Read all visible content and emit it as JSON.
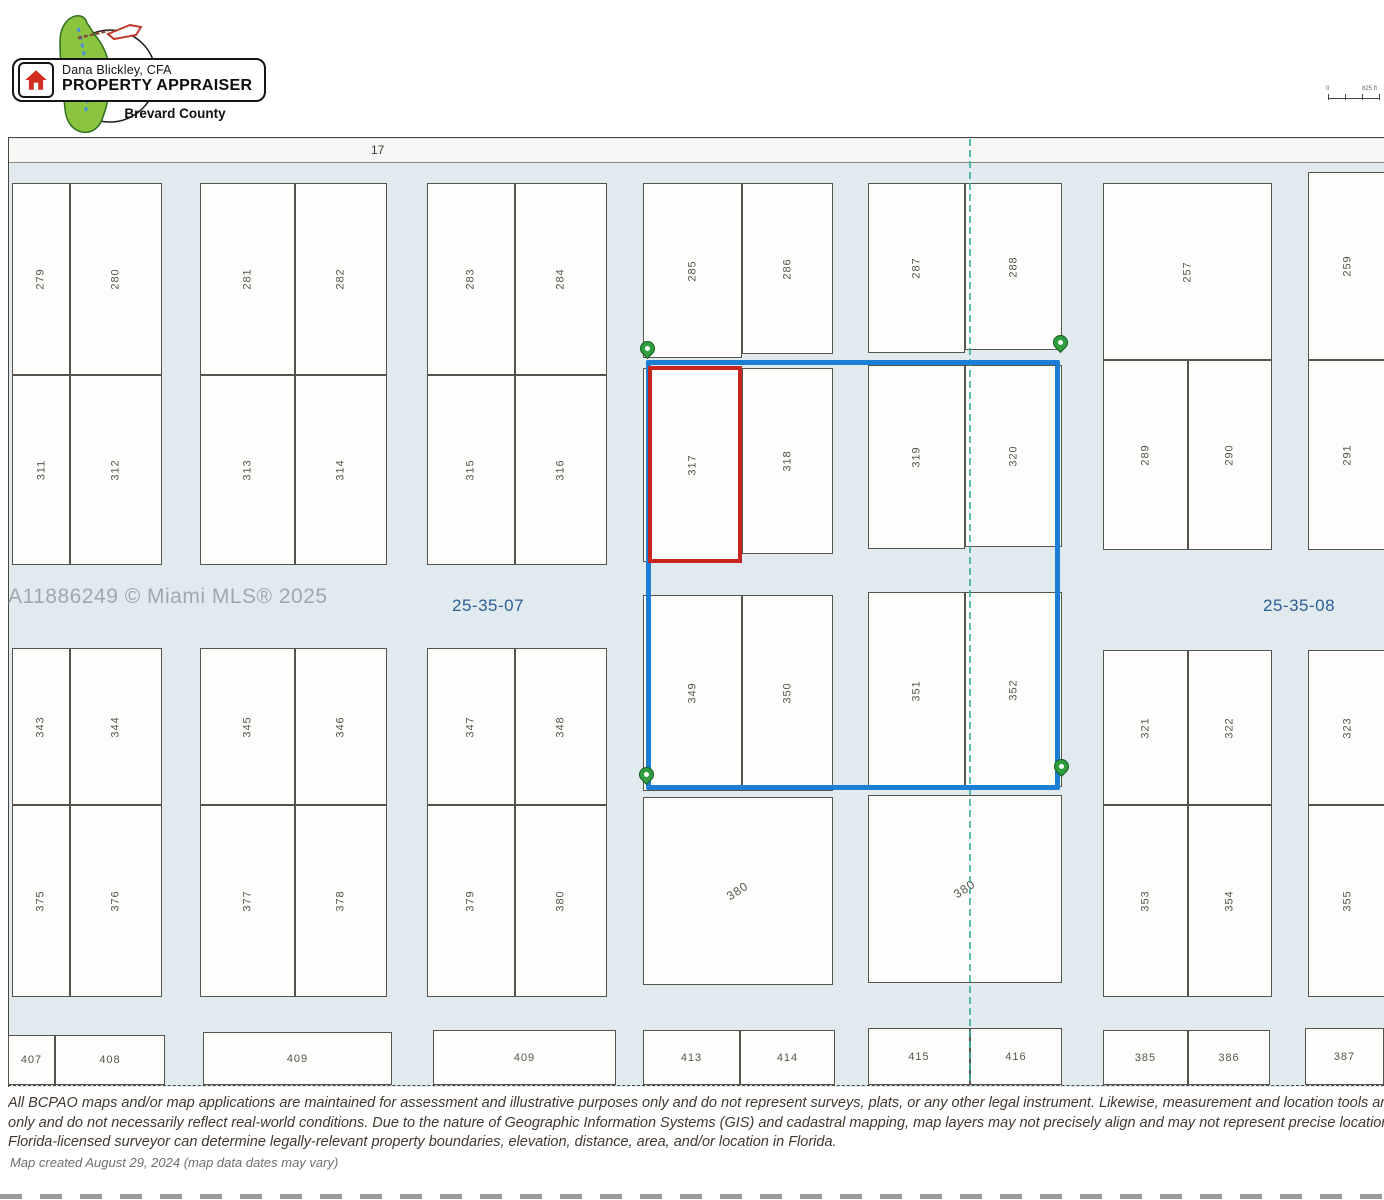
{
  "header": {
    "logo": {
      "line1": "Dana Blickley, CFA",
      "line2": "PROPERTY APPRAISER",
      "line3": "Brevard County"
    },
    "scale_bar": {
      "start": "0",
      "end": "825 ft"
    }
  },
  "map": {
    "road_label": "17",
    "watermark": "A11886249 © Miami MLS® 2025",
    "section_labels": [
      {
        "text": "25-35-07"
      },
      {
        "text": "25-35-08"
      }
    ],
    "section_line_x": 969,
    "selection_box": {
      "x": 646,
      "y": 360,
      "w": 414,
      "h": 430
    },
    "highlight_box": {
      "x": 648,
      "y": 366,
      "w": 94,
      "h": 197
    },
    "pins": [
      {
        "x": 647,
        "y": 353
      },
      {
        "x": 1060,
        "y": 347
      },
      {
        "x": 646,
        "y": 779
      },
      {
        "x": 1061,
        "y": 771
      }
    ],
    "colors": {
      "street": "#e1eaef",
      "parcel": "#fdfdfb",
      "parcelBorder": "#55534a",
      "road": "#f7f8f5",
      "blue": "#1a7fd4",
      "red": "#c6261d",
      "teal": "#3fae9f",
      "pinFill": "#2f9e3e",
      "pinStroke": "#15591f",
      "label": "#56544e",
      "watermark": "#9aa1a7",
      "sectionLabel": "#2c5f97",
      "disclaimer": "#41382e",
      "note": "#6e6e6e",
      "mapBorder": "#47453e"
    },
    "parcels": [
      {
        "n": "279",
        "x": 12,
        "y": 183,
        "w": 58,
        "h": 192,
        "r": "v"
      },
      {
        "n": "280",
        "x": 70,
        "y": 183,
        "w": 92,
        "h": 192,
        "r": "v"
      },
      {
        "n": "281",
        "x": 200,
        "y": 183,
        "w": 95,
        "h": 192,
        "r": "v"
      },
      {
        "n": "282",
        "x": 295,
        "y": 183,
        "w": 92,
        "h": 192,
        "r": "v"
      },
      {
        "n": "283",
        "x": 427,
        "y": 183,
        "w": 88,
        "h": 192,
        "r": "v"
      },
      {
        "n": "284",
        "x": 515,
        "y": 183,
        "w": 92,
        "h": 192,
        "r": "v"
      },
      {
        "n": "285",
        "x": 643,
        "y": 183,
        "w": 99,
        "h": 175,
        "r": "v"
      },
      {
        "n": "286",
        "x": 742,
        "y": 183,
        "w": 91,
        "h": 171,
        "r": "v"
      },
      {
        "n": "287",
        "x": 868,
        "y": 183,
        "w": 97,
        "h": 170,
        "r": "v"
      },
      {
        "n": "288",
        "x": 965,
        "y": 183,
        "w": 97,
        "h": 167,
        "r": "v"
      },
      {
        "n": "257",
        "x": 1103,
        "y": 183,
        "w": 169,
        "h": 177,
        "r": "v"
      },
      {
        "n": "259",
        "x": 1308,
        "y": 172,
        "w": 80,
        "h": 188,
        "r": "v"
      },
      {
        "n": "311",
        "x": 12,
        "y": 375,
        "w": 58,
        "h": 190,
        "r": "v"
      },
      {
        "n": "312",
        "x": 70,
        "y": 375,
        "w": 92,
        "h": 190,
        "r": "v"
      },
      {
        "n": "313",
        "x": 200,
        "y": 375,
        "w": 95,
        "h": 190,
        "r": "v"
      },
      {
        "n": "314",
        "x": 295,
        "y": 375,
        "w": 92,
        "h": 190,
        "r": "v"
      },
      {
        "n": "315",
        "x": 427,
        "y": 375,
        "w": 88,
        "h": 190,
        "r": "v"
      },
      {
        "n": "316",
        "x": 515,
        "y": 375,
        "w": 92,
        "h": 190,
        "r": "v"
      },
      {
        "n": "317",
        "x": 643,
        "y": 368,
        "w": 99,
        "h": 194,
        "r": "v"
      },
      {
        "n": "318",
        "x": 742,
        "y": 368,
        "w": 91,
        "h": 186,
        "r": "v"
      },
      {
        "n": "319",
        "x": 868,
        "y": 365,
        "w": 97,
        "h": 184,
        "r": "v"
      },
      {
        "n": "320",
        "x": 965,
        "y": 365,
        "w": 97,
        "h": 182,
        "r": "v"
      },
      {
        "n": "289",
        "x": 1103,
        "y": 360,
        "w": 85,
        "h": 190,
        "r": "v"
      },
      {
        "n": "290",
        "x": 1188,
        "y": 360,
        "w": 84,
        "h": 190,
        "r": "v"
      },
      {
        "n": "291",
        "x": 1308,
        "y": 360,
        "w": 80,
        "h": 190,
        "r": "v"
      },
      {
        "n": "343",
        "x": 12,
        "y": 648,
        "w": 58,
        "h": 157,
        "r": "v"
      },
      {
        "n": "344",
        "x": 70,
        "y": 648,
        "w": 92,
        "h": 157,
        "r": "v"
      },
      {
        "n": "345",
        "x": 200,
        "y": 648,
        "w": 95,
        "h": 157,
        "r": "v"
      },
      {
        "n": "346",
        "x": 295,
        "y": 648,
        "w": 92,
        "h": 157,
        "r": "v"
      },
      {
        "n": "347",
        "x": 427,
        "y": 648,
        "w": 88,
        "h": 157,
        "r": "v"
      },
      {
        "n": "348",
        "x": 515,
        "y": 648,
        "w": 92,
        "h": 157,
        "r": "v"
      },
      {
        "n": "349",
        "x": 643,
        "y": 595,
        "w": 99,
        "h": 196,
        "r": "v"
      },
      {
        "n": "350",
        "x": 742,
        "y": 595,
        "w": 91,
        "h": 196,
        "r": "v"
      },
      {
        "n": "351",
        "x": 868,
        "y": 592,
        "w": 97,
        "h": 197,
        "r": "v"
      },
      {
        "n": "352",
        "x": 965,
        "y": 592,
        "w": 97,
        "h": 195,
        "r": "v"
      },
      {
        "n": "321",
        "x": 1103,
        "y": 650,
        "w": 85,
        "h": 155,
        "r": "v"
      },
      {
        "n": "322",
        "x": 1188,
        "y": 650,
        "w": 84,
        "h": 155,
        "r": "v"
      },
      {
        "n": "323",
        "x": 1308,
        "y": 650,
        "w": 80,
        "h": 155,
        "r": "v"
      },
      {
        "n": "375",
        "x": 12,
        "y": 805,
        "w": 58,
        "h": 192,
        "r": "v"
      },
      {
        "n": "376",
        "x": 70,
        "y": 805,
        "w": 92,
        "h": 192,
        "r": "v"
      },
      {
        "n": "377",
        "x": 200,
        "y": 805,
        "w": 95,
        "h": 192,
        "r": "v"
      },
      {
        "n": "378",
        "x": 295,
        "y": 805,
        "w": 92,
        "h": 192,
        "r": "v"
      },
      {
        "n": "379",
        "x": 427,
        "y": 805,
        "w": 88,
        "h": 192,
        "r": "v"
      },
      {
        "n": "380",
        "x": 515,
        "y": 805,
        "w": 92,
        "h": 192,
        "r": "v"
      },
      {
        "n": "380",
        "x": 643,
        "y": 797,
        "w": 190,
        "h": 188,
        "r": "d"
      },
      {
        "n": "380",
        "x": 868,
        "y": 795,
        "w": 194,
        "h": 188,
        "r": "d"
      },
      {
        "n": "353",
        "x": 1103,
        "y": 805,
        "w": 85,
        "h": 192,
        "r": "v"
      },
      {
        "n": "354",
        "x": 1188,
        "y": 805,
        "w": 84,
        "h": 192,
        "r": "v"
      },
      {
        "n": "355",
        "x": 1308,
        "y": 805,
        "w": 80,
        "h": 192,
        "r": "v"
      },
      {
        "n": "407",
        "x": 8,
        "y": 1035,
        "w": 47,
        "h": 50,
        "r": "h"
      },
      {
        "n": "408",
        "x": 55,
        "y": 1035,
        "w": 110,
        "h": 50,
        "r": "h"
      },
      {
        "n": "409",
        "x": 203,
        "y": 1032,
        "w": 189,
        "h": 53,
        "r": "h"
      },
      {
        "n": "409",
        "x": 433,
        "y": 1030,
        "w": 183,
        "h": 55,
        "r": "h"
      },
      {
        "n": "413",
        "x": 643,
        "y": 1030,
        "w": 97,
        "h": 55,
        "r": "h"
      },
      {
        "n": "414",
        "x": 740,
        "y": 1030,
        "w": 95,
        "h": 55,
        "r": "h"
      },
      {
        "n": "415",
        "x": 868,
        "y": 1028,
        "w": 102,
        "h": 57,
        "r": "h"
      },
      {
        "n": "416",
        "x": 970,
        "y": 1028,
        "w": 92,
        "h": 57,
        "r": "h"
      },
      {
        "n": "385",
        "x": 1103,
        "y": 1030,
        "w": 85,
        "h": 55,
        "r": "h"
      },
      {
        "n": "386",
        "x": 1188,
        "y": 1030,
        "w": 82,
        "h": 55,
        "r": "h"
      },
      {
        "n": "387",
        "x": 1305,
        "y": 1028,
        "w": 79,
        "h": 57,
        "r": "h"
      }
    ]
  },
  "footer": {
    "disclaimer_lines": [
      "All BCPAO maps and/or map applications are maintained for assessment and illustrative purposes only and do not represent surveys, plats, or any other legal instrument. Likewise, measurement and location tools are t",
      "only and do not necessarily reflect real-world conditions. Due to the nature of Geographic Information Systems (GIS) and cadastral mapping, map layers may not precisely align and may not represent precise location, s",
      "Florida-licensed surveyor can determine legally-relevant property boundaries, elevation, distance, area, and/or location in Florida."
    ],
    "created_note": "Map created August 29, 2024 (map data dates may vary)"
  }
}
